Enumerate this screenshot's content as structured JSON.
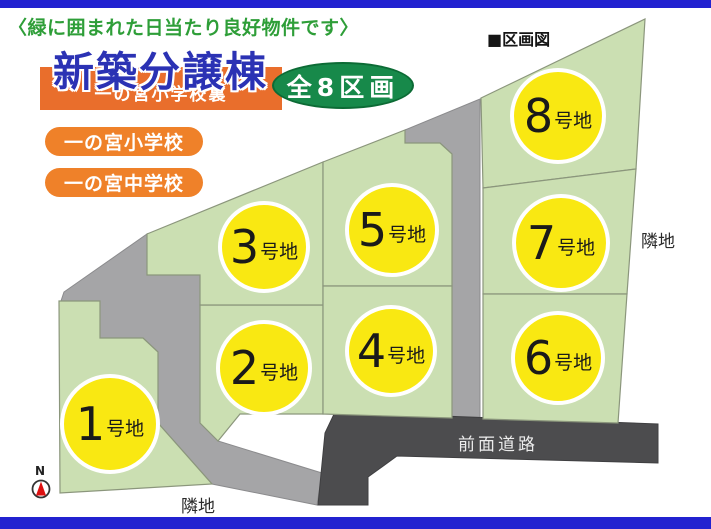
{
  "header": {
    "note": "〈緑に囲まれた日当たり良好物件です〉",
    "section_label": "■区画図"
  },
  "title": {
    "main": "新築分譲棟",
    "subtitle_banner": "一の宮小学校裏",
    "badge": "全8区画"
  },
  "school_tags": [
    {
      "label": "一の宮小学校"
    },
    {
      "label": "一の宮中学校"
    }
  ],
  "lots": [
    {
      "number": "1",
      "suffix": "号地"
    },
    {
      "number": "2",
      "suffix": "号地"
    },
    {
      "number": "3",
      "suffix": "号地"
    },
    {
      "number": "4",
      "suffix": "号地"
    },
    {
      "number": "5",
      "suffix": "号地"
    },
    {
      "number": "6",
      "suffix": "号地"
    },
    {
      "number": "7",
      "suffix": "号地"
    },
    {
      "number": "8",
      "suffix": "号地"
    }
  ],
  "map_labels": {
    "front_road": "前面道路",
    "adjacent_land_right": "隣地",
    "adjacent_land_bottom": "隣地",
    "compass_north": "N"
  },
  "colors": {
    "frame_blue": "#2222d0",
    "title_blue": "#2b32b4",
    "banner_orange": "#e96e2c",
    "pill_orange": "#ef8129",
    "badge_green": "#17894a",
    "note_green": "#2e9e38",
    "lot_green": "#cbdfb2",
    "lot_circle_yellow": "#f9e812",
    "road_gray": "#a5a5a7",
    "front_road_dark": "#4c4c4e",
    "compass_red": "#dd1111"
  }
}
